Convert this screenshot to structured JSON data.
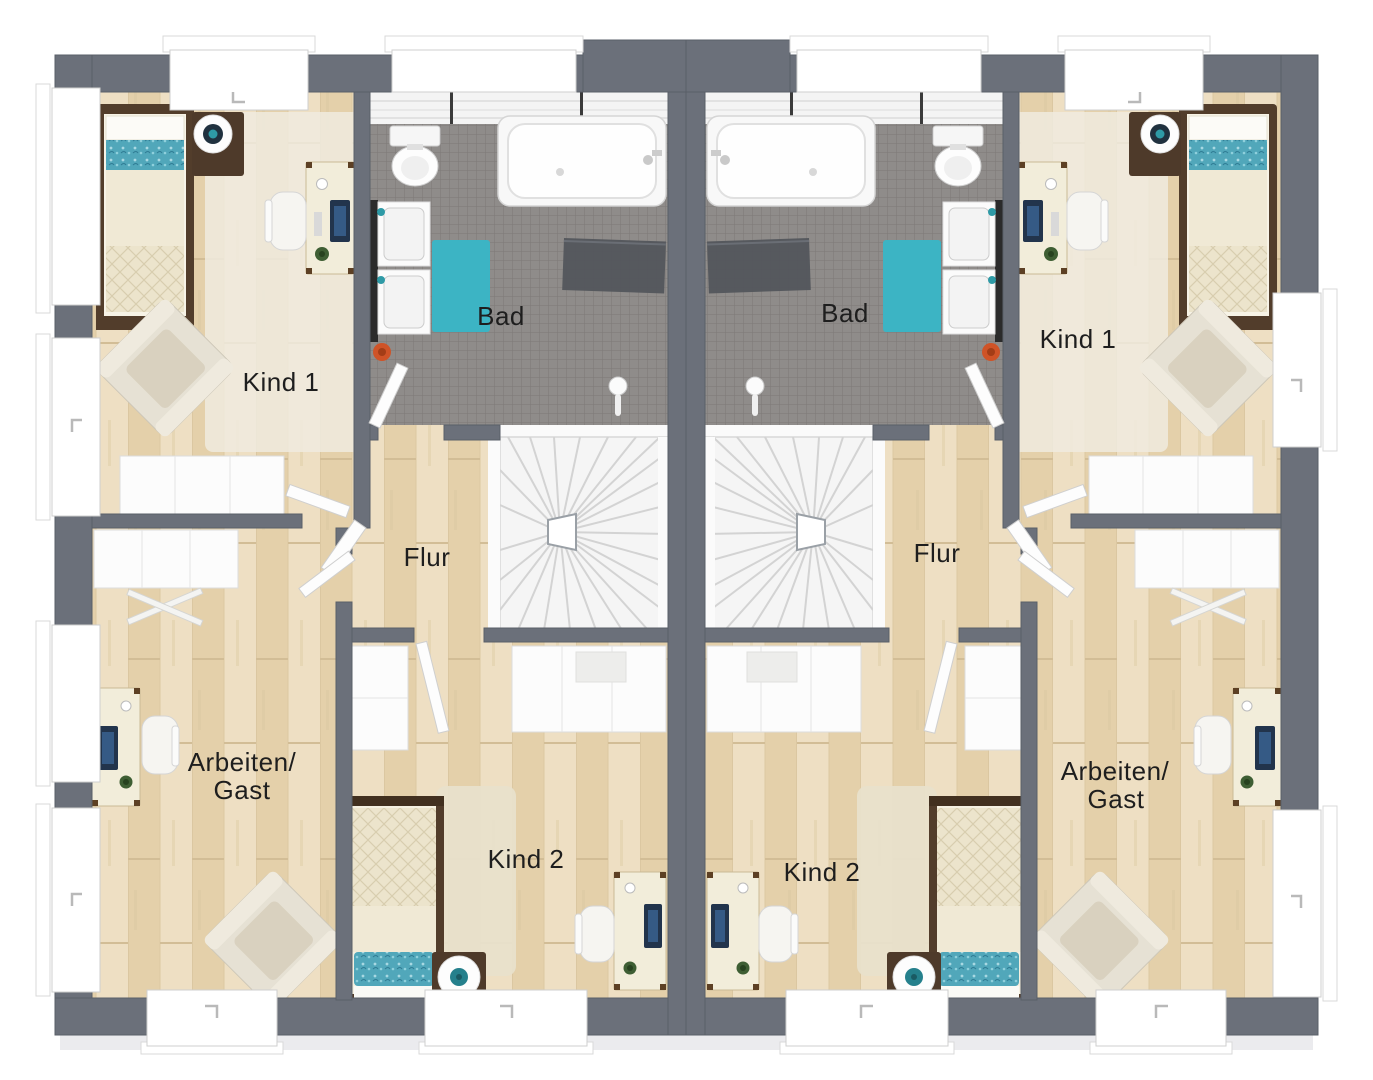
{
  "plan": {
    "type": "floor-plan",
    "units": {
      "left": {
        "bad": "Bad",
        "kind1": "Kind 1",
        "flur": "Flur",
        "arbeiten_line1": "Arbeiten/",
        "arbeiten_line2": "Gast",
        "kind2": "Kind 2"
      },
      "right": {
        "bad": "Bad",
        "kind1": "Kind 1",
        "flur": "Flur",
        "arbeiten_line1": "Arbeiten/",
        "arbeiten_line2": "Gast",
        "kind2": "Kind 2"
      }
    },
    "colors": {
      "wall": "#6b707a",
      "wood_floor": "#e9d9b8",
      "bath_tile": "#8f8c8a",
      "stairs": "#f5f5f5",
      "rug_teal": "#3cb4c4",
      "bedding_teal": "#51a7ba",
      "bedding_cream": "#ece4cc",
      "furniture_wood_dark": "#523d2b",
      "desk_cream": "#f2edda",
      "label_text": "#1e1e1e"
    }
  }
}
